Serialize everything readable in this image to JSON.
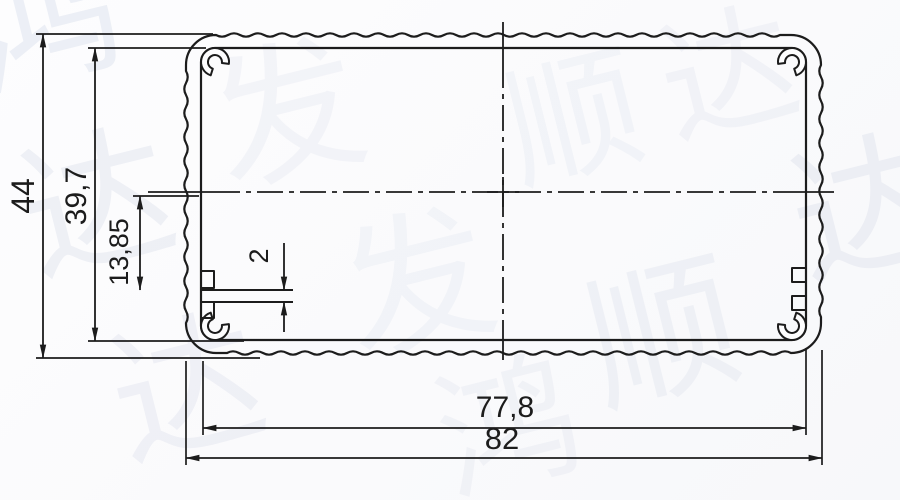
{
  "drawing": {
    "dimensions": {
      "overall_height": {
        "label": "44"
      },
      "inner_height": {
        "label": "39,7"
      },
      "rib_offset": {
        "label": "13,85"
      },
      "rib_thickness": {
        "label": "2"
      },
      "inner_width": {
        "label": "77,8"
      },
      "overall_width": {
        "label": "82"
      }
    }
  },
  "watermark": {
    "text": "鸿发顺达",
    "characters": [
      "鸿",
      "发",
      "顺",
      "达"
    ]
  },
  "colors": {
    "line": "#1c1c1c",
    "background": "#fcfcfd",
    "watermark": "#dfe3ee"
  }
}
